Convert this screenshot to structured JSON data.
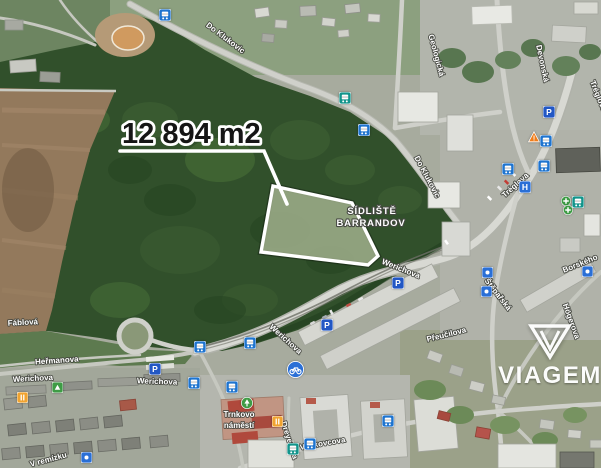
{
  "map": {
    "area_label": "12 894 m2",
    "district_label": {
      "line1": "SÍDLIŠTĚ",
      "line2": "BARRANDOV"
    },
    "street_labels": [
      {
        "text": "Do Klukovic",
        "x": 224,
        "y": 40,
        "rot": 37
      },
      {
        "text": "Do Klukovic",
        "x": 425,
        "y": 178,
        "rot": 62
      },
      {
        "text": "Geologická",
        "x": 434,
        "y": 56,
        "rot": 75
      },
      {
        "text": "Devonská",
        "x": 540,
        "y": 64,
        "rot": 78
      },
      {
        "text": "Tréglova",
        "x": 596,
        "y": 97,
        "rot": 68
      },
      {
        "text": "Tréglova",
        "x": 517,
        "y": 187,
        "rot": -42
      },
      {
        "text": "Borského",
        "x": 581,
        "y": 266,
        "rot": -22
      },
      {
        "text": "Štěpařská",
        "x": 496,
        "y": 296,
        "rot": 52
      },
      {
        "text": "Högerova",
        "x": 569,
        "y": 322,
        "rot": 70
      },
      {
        "text": "Přeučilova",
        "x": 447,
        "y": 337,
        "rot": -14
      },
      {
        "text": "Werichova",
        "x": 400,
        "y": 271,
        "rot": 22
      },
      {
        "text": "Werichova",
        "x": 284,
        "y": 341,
        "rot": 42
      },
      {
        "text": "Werichova",
        "x": 157,
        "y": 384,
        "rot": 2
      },
      {
        "text": "Werichova",
        "x": 33,
        "y": 381,
        "rot": -3
      },
      {
        "text": "Heřmanova",
        "x": 57,
        "y": 363,
        "rot": -4
      },
      {
        "text": "Fáblová",
        "x": 23,
        "y": 325,
        "rot": -3
      },
      {
        "text": "V remízku",
        "x": 49,
        "y": 462,
        "rot": -15
      },
      {
        "text": "Voskovcova",
        "x": 323,
        "y": 446,
        "rot": -10
      },
      {
        "text": "Dreyerova",
        "x": 287,
        "y": 441,
        "rot": 72
      },
      {
        "text": "Trnkovo",
        "x": 239,
        "y": 417,
        "rot": 0
      },
      {
        "text": "náměstí",
        "x": 239,
        "y": 428,
        "rot": 0
      }
    ],
    "icons": [
      {
        "type": "bus",
        "x": 165,
        "y": 15
      },
      {
        "type": "tram",
        "x": 345,
        "y": 98
      },
      {
        "type": "bus",
        "x": 364,
        "y": 130
      },
      {
        "type": "parking",
        "x": 549,
        "y": 112
      },
      {
        "type": "warning",
        "x": 534,
        "y": 137
      },
      {
        "type": "bus",
        "x": 546,
        "y": 141
      },
      {
        "type": "bus",
        "x": 508,
        "y": 169
      },
      {
        "type": "bus",
        "x": 544,
        "y": 166
      },
      {
        "type": "hospital",
        "x": 525,
        "y": 187
      },
      {
        "type": "pharmacy",
        "x": 567,
        "y": 202
      },
      {
        "type": "pharmacy",
        "x": 569,
        "y": 211
      },
      {
        "type": "tram",
        "x": 578,
        "y": 202
      },
      {
        "type": "generic",
        "x": 588,
        "y": 272
      },
      {
        "type": "generic",
        "x": 488,
        "y": 273
      },
      {
        "type": "generic",
        "x": 487,
        "y": 292
      },
      {
        "type": "parking",
        "x": 398,
        "y": 283
      },
      {
        "type": "parking",
        "x": 327,
        "y": 325
      },
      {
        "type": "bus",
        "x": 200,
        "y": 347
      },
      {
        "type": "bus",
        "x": 250,
        "y": 343
      },
      {
        "type": "parking",
        "x": 155,
        "y": 369
      },
      {
        "type": "bus",
        "x": 232,
        "y": 387
      },
      {
        "type": "bus",
        "x": 194,
        "y": 383
      },
      {
        "type": "bike",
        "x": 295,
        "y": 369
      },
      {
        "type": "tree",
        "x": 247,
        "y": 403
      },
      {
        "type": "food",
        "x": 278,
        "y": 422
      },
      {
        "type": "playground",
        "x": 58,
        "y": 388
      },
      {
        "type": "food",
        "x": 23,
        "y": 398
      },
      {
        "type": "bus",
        "x": 310,
        "y": 444
      },
      {
        "type": "tram",
        "x": 293,
        "y": 449
      },
      {
        "type": "bus",
        "x": 388,
        "y": 421
      },
      {
        "type": "generic",
        "x": 87,
        "y": 458
      }
    ],
    "icon_glyphs": {
      "parking": "P",
      "hospital": "H",
      "warning": "!"
    },
    "colors": {
      "parcel_outline": "#ffffff",
      "area_label_text": "#151515",
      "street_label_text": "#ffffff",
      "icon_bus": "#1e74cf",
      "icon_tram": "#12948b",
      "icon_parking": "#2257c4",
      "icon_generic": "#2a6fd6",
      "icon_green": "#3e9b45",
      "icon_orange": "#f0a330",
      "icon_warning": "#f07d1a"
    }
  },
  "watermark": {
    "brand": "VIAGEM"
  }
}
